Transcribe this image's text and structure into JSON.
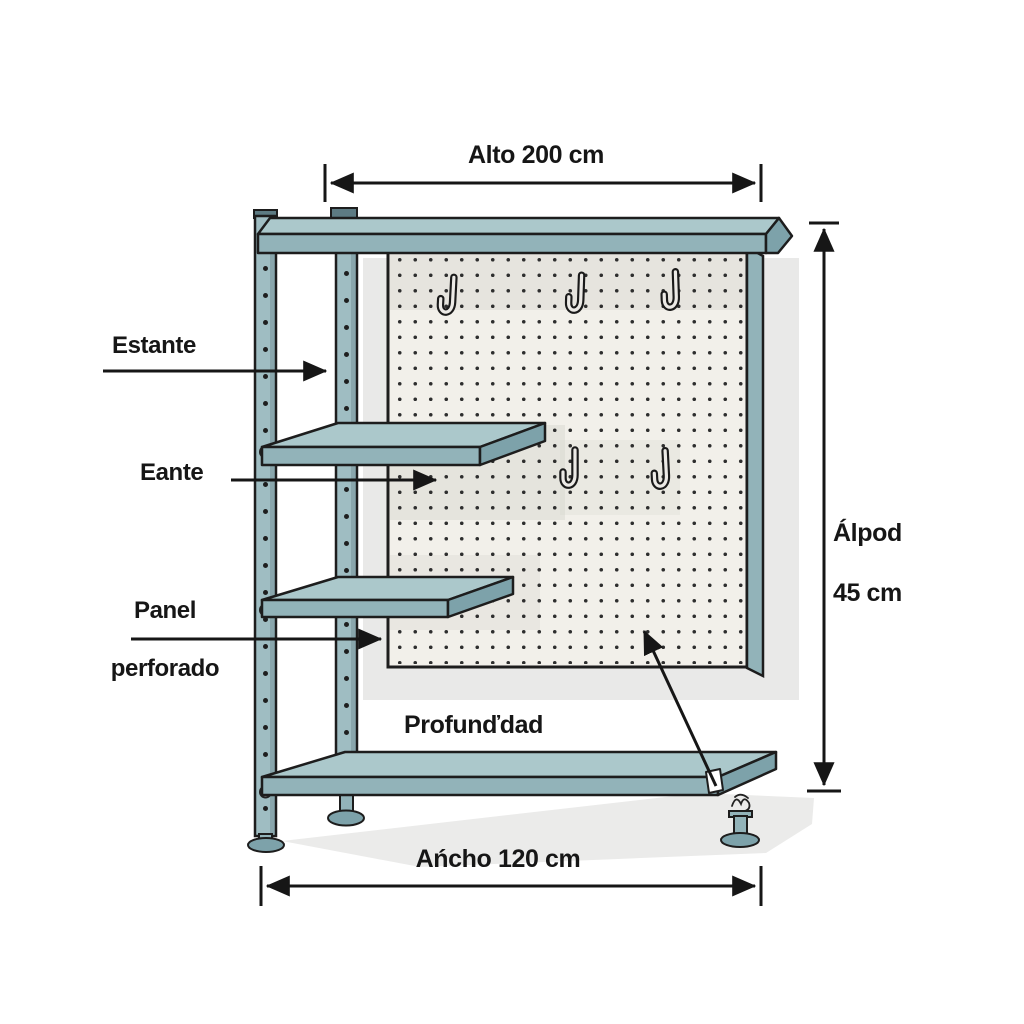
{
  "labels": {
    "estante": "Estante",
    "eante": "Eante",
    "panel_line1": "Panel",
    "panel_line2": "perforado",
    "profundidad": "Profunďdad"
  },
  "dimensions": {
    "alto": "Alto 200 cm",
    "ancho": "Ańcho 120 cm",
    "fondo_line1": "Álpod",
    "fondo_line2": "45 cm"
  },
  "pegboard": {
    "hook_count": 5,
    "shelf_count": 4
  },
  "icons": {
    "hook": "j-hook-icon",
    "foot": "leveling-foot-icon",
    "arrowhead": "dimension-arrow"
  },
  "colors": {
    "canvas_bg": "#ffffff",
    "ink": "#161616",
    "outline": "#1d1d1d",
    "shelf_top": "#abc8cb",
    "shelf_front": "#92b3b9",
    "shelf_side": "#7da2aa",
    "post": "#9fbdc2",
    "post_dark": "#5d7b83",
    "pegboard_bg": "#f2f0ea",
    "pegboard_band": "#d9d7d1",
    "pegboard_dot": "#2e2e2e",
    "back_panel": "#e9e9e8",
    "floor_shadow": "#ebebea"
  }
}
